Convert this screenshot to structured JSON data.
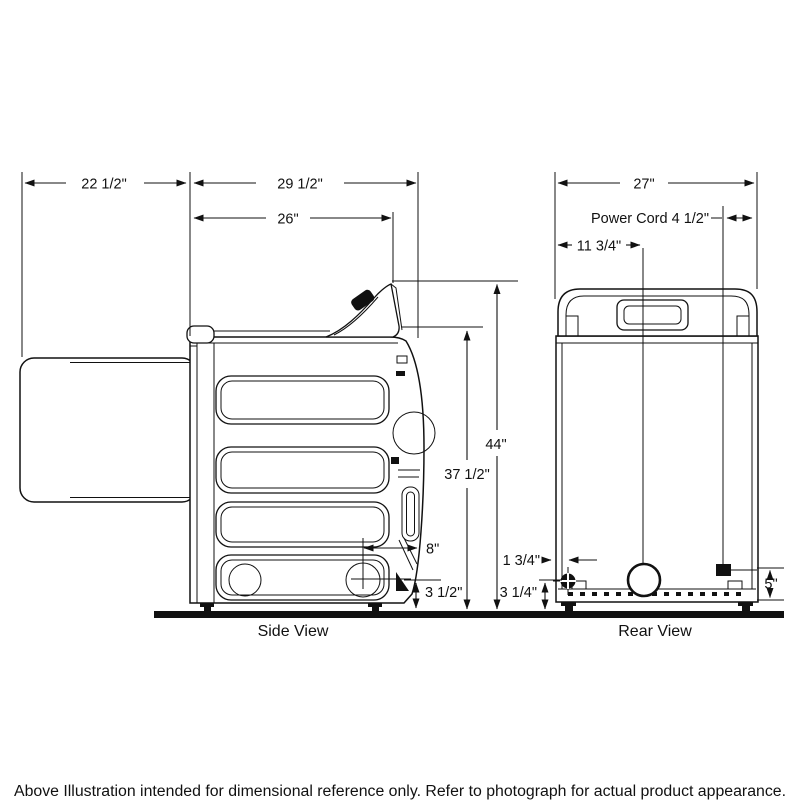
{
  "footnote": "Above Illustration intended for dimensional reference only. Refer to photograph for actual product appearance.",
  "views": {
    "side": {
      "label": "Side View"
    },
    "rear": {
      "label": "Rear View"
    }
  },
  "dimensions": {
    "side": {
      "door_depth": "22 1/2\"",
      "overall_depth": "29 1/2\"",
      "top_depth": "26\"",
      "console_height": "44\"",
      "lid_height": "37 1/2\"",
      "vent_from_rear": "8\"",
      "vent_height": "3 1/2\""
    },
    "rear": {
      "width": "27\"",
      "power_cord": "Power Cord 4 1/2\"",
      "vent_offset": "11 3/4\"",
      "gas_offset": "1 3/4\"",
      "gas_height": "3 1/4\"",
      "cord_height": "5\""
    }
  }
}
